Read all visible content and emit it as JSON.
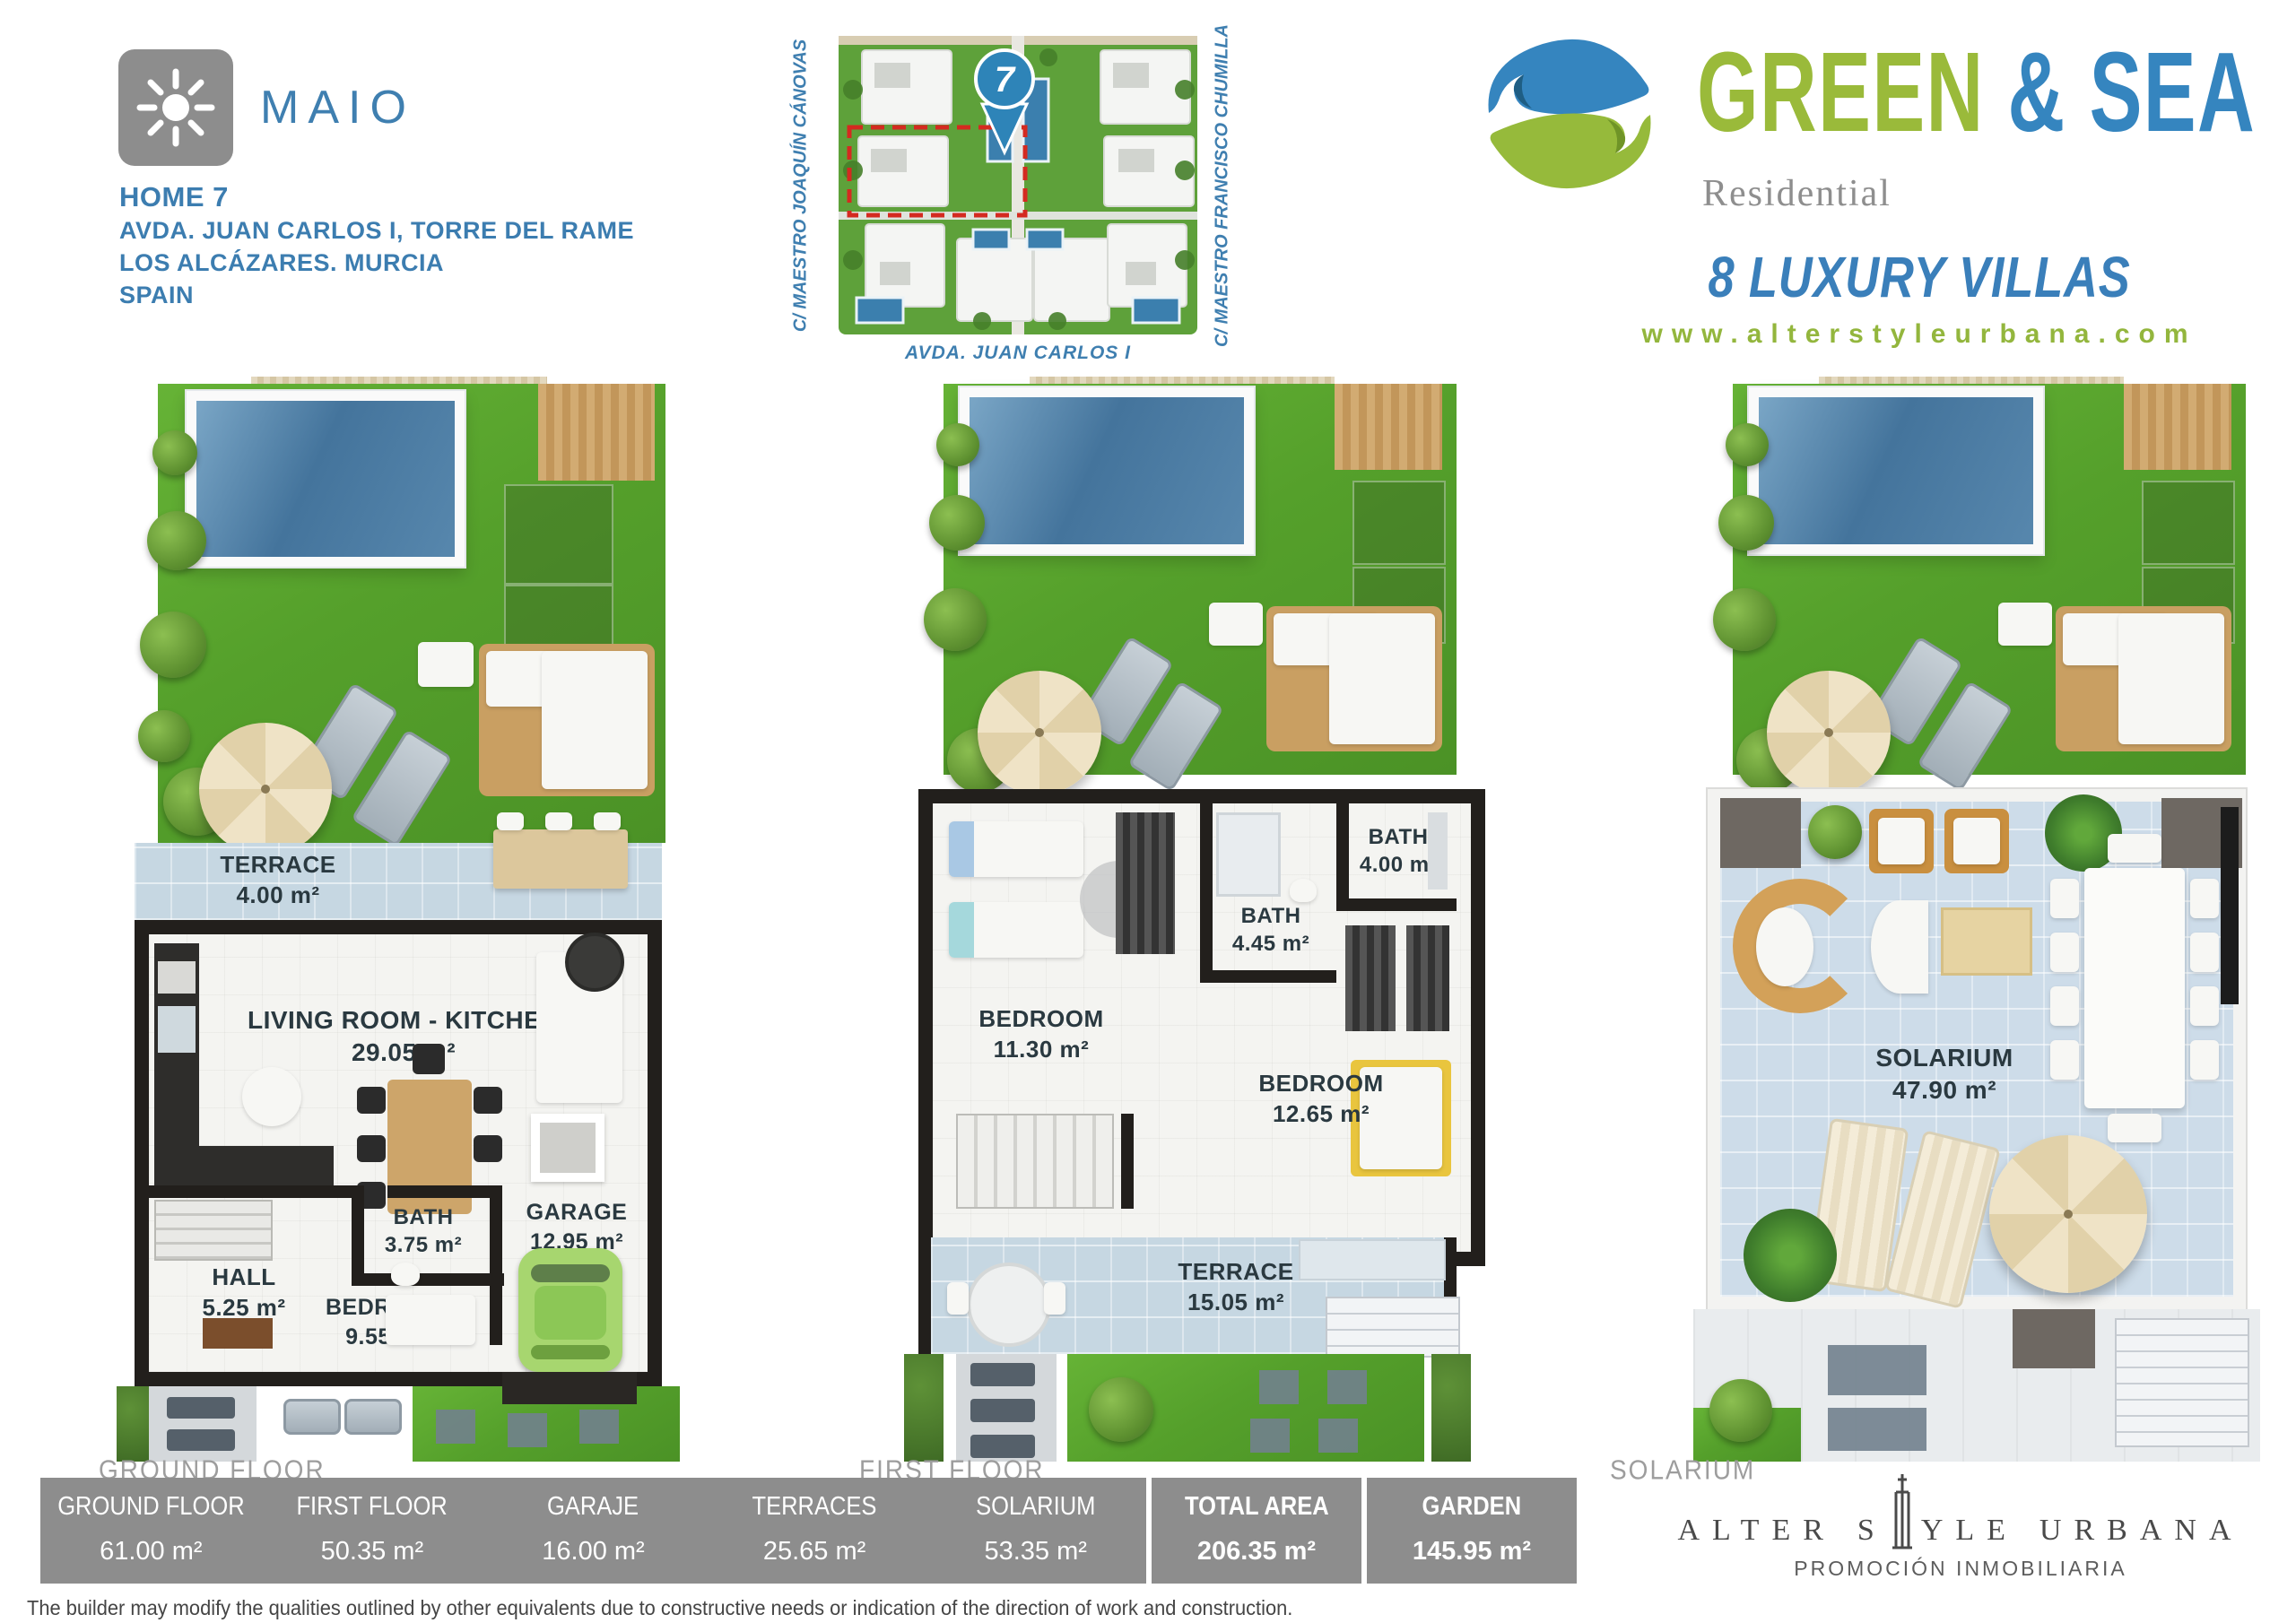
{
  "colors": {
    "brand_blue": "#3f7fb0",
    "logo_green": "#9aba3a",
    "logo_blue": "#3585bf",
    "website_green": "#93b63d",
    "table_gray": "#8d8d8d",
    "wall_dark": "#221f1c",
    "grass_green": "#57a22c",
    "pool_blue": "#4d82aa",
    "label_dark": "#2a3940",
    "highlight_red": "#d42a20"
  },
  "header": {
    "brand": {
      "name": "MAIO",
      "home": "HOME 7",
      "address1": "AVDA. JUAN CARLOS I, TORRE DEL RAME",
      "address2": "LOS ALCÁZARES. MURCIA",
      "address3": "SPAIN"
    },
    "siteplan": {
      "pin_number": "7",
      "street_left": "C/ MAESTRO JOAQUÍN CÁNOVAS",
      "street_right": "C/ MAESTRO FRANCISCO CHUMILLA",
      "street_bottom": "AVDA. JUAN CARLOS I"
    },
    "logo": {
      "word_green": "GREEN",
      "word_amp": " & ",
      "word_sea": "SEA",
      "subtitle": "Residential",
      "tagline": "8 LUXURY VILLAS",
      "website": "www.alterstyleurbana.com"
    }
  },
  "plans": [
    {
      "caption": "GROUND FLOOR",
      "labels": {
        "terrace": {
          "name": "TERRACE",
          "area": "4.00 m²"
        },
        "living": {
          "name": "LIVING ROOM - KITCHEN",
          "area": "29.05 m²"
        },
        "hall": {
          "name": "HALL",
          "area": "5.25 m²"
        },
        "bath": {
          "name": "BATH",
          "area": "3.75 m²"
        },
        "bedroom": {
          "name": "BEDROOM",
          "area": "9.55 m²"
        },
        "garage": {
          "name": "GARAGE",
          "area": "12.95 m²"
        }
      }
    },
    {
      "caption": "FIRST FLOOR",
      "labels": {
        "bedroom_left": {
          "name": "BEDROOM",
          "area": "11.30 m²"
        },
        "bath_mid": {
          "name": "BATH",
          "area": "4.45 m²"
        },
        "bath_top": {
          "name": "BATH",
          "area": "4.00 m²"
        },
        "bedroom_right": {
          "name": "BEDROOM",
          "area": "12.65 m²"
        },
        "terrace": {
          "name": "TERRACE",
          "area": "15.05 m²"
        }
      }
    },
    {
      "caption": "SOLARIUM",
      "labels": {
        "solarium": {
          "name": "SOLARIUM",
          "area": "47.90 m²"
        }
      }
    }
  ],
  "table": {
    "columns": [
      {
        "label": "GROUND FLOOR",
        "value": "61.00 m²"
      },
      {
        "label": "FIRST FLOOR",
        "value": "50.35 m²"
      },
      {
        "label": "GARAJE",
        "value": "16.00 m²"
      },
      {
        "label": "TERRACES",
        "value": "25.65 m²"
      },
      {
        "label": "SOLARIUM",
        "value": "53.35 m²"
      }
    ],
    "totals": [
      {
        "label": "TOTAL AREA",
        "value": "206.35 m²"
      },
      {
        "label": "GARDEN",
        "value": "145.95 m²"
      }
    ]
  },
  "footer": {
    "publisher": {
      "part1": "ALTER",
      "part2": "S",
      "part3": "YLE",
      "part4": "URBANA",
      "subtitle": "PROMOCIÓN INMOBILIARIA"
    },
    "disclaimer": "The builder may modify the qualities outlined by other equivalents due to constructive needs or indication of the direction of work and construction."
  }
}
